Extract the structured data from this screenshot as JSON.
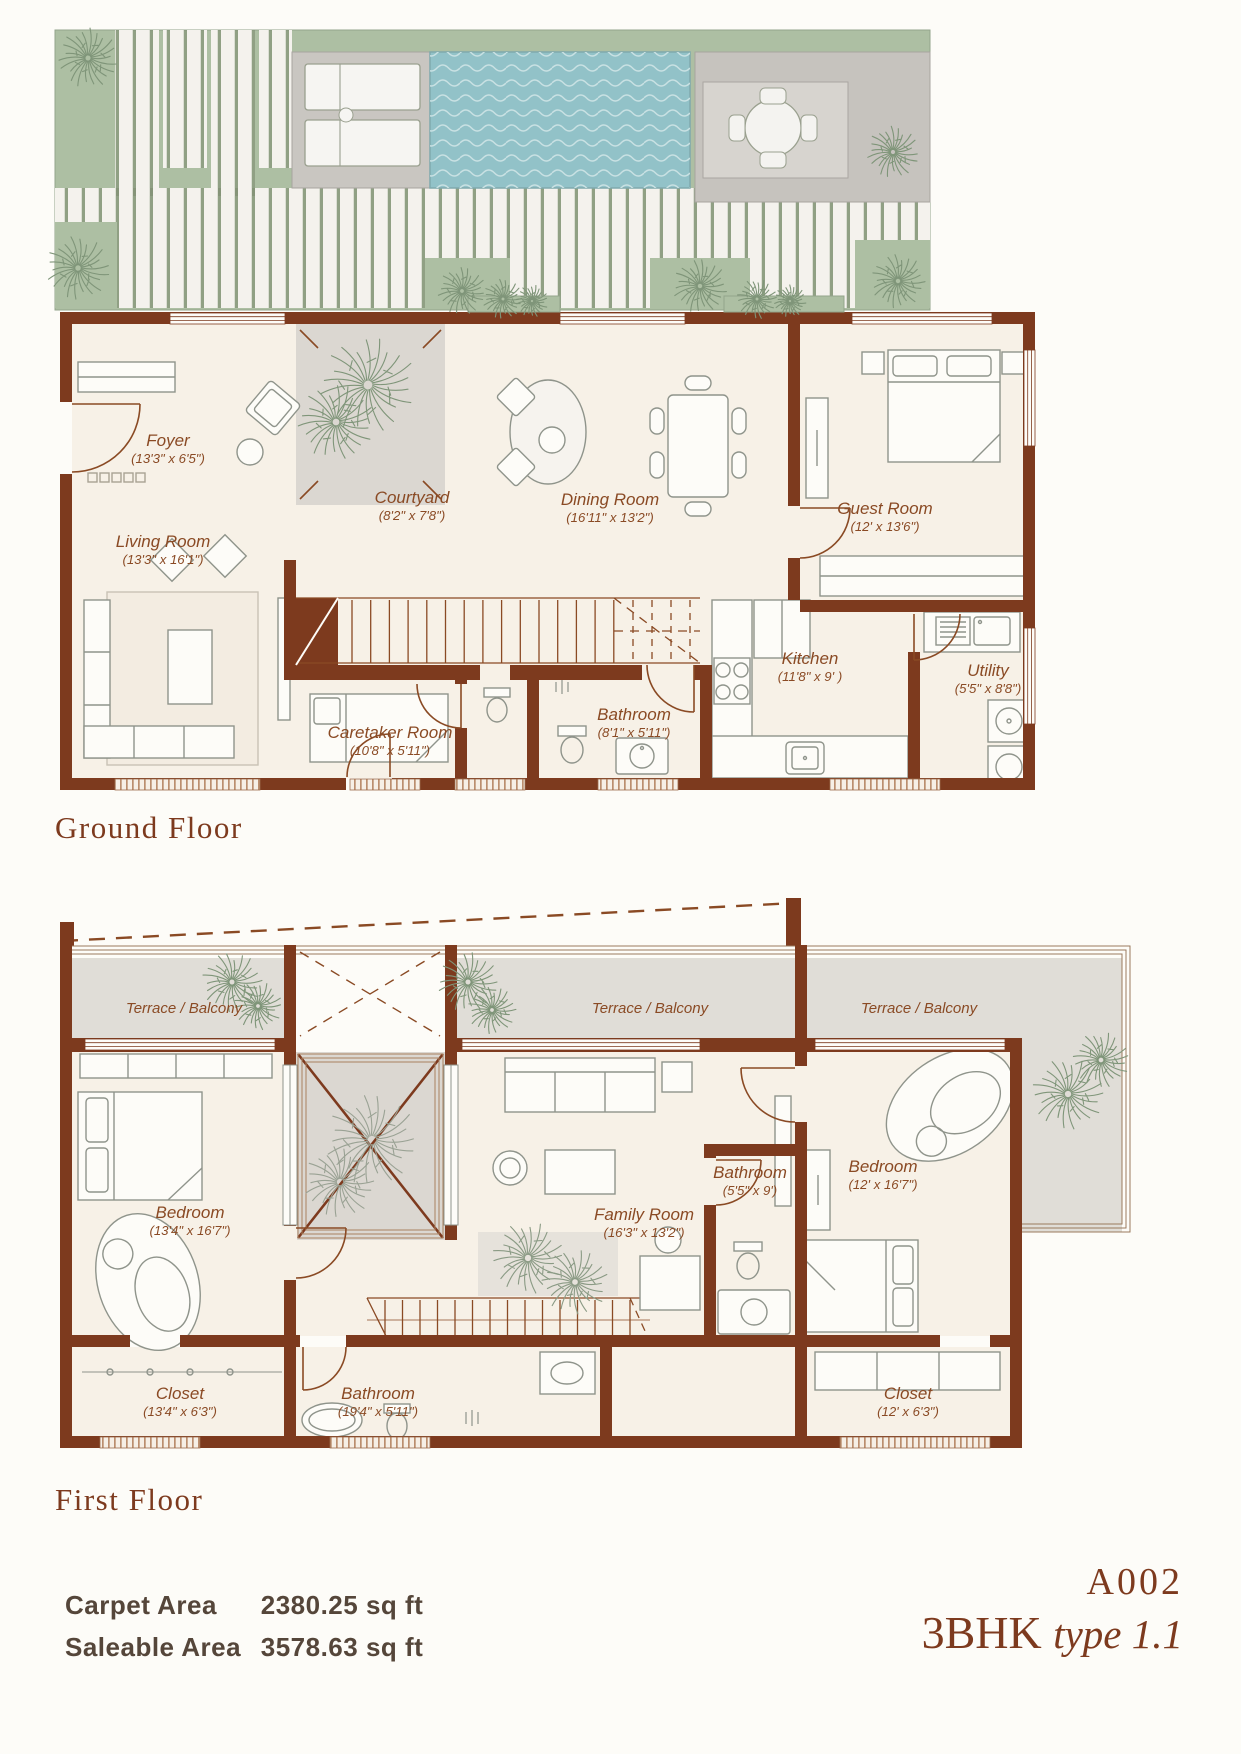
{
  "floors": {
    "ground": {
      "title": "Ground Floor",
      "rooms": [
        {
          "id": "foyer",
          "name": "Foyer",
          "dims": "(13'3\" x 6'5\")"
        },
        {
          "id": "living",
          "name": "Living Room",
          "dims": "(13'3\" x 16'1\")"
        },
        {
          "id": "courtyard",
          "name": "Courtyard",
          "dims": "(8'2\" x 7'8\")"
        },
        {
          "id": "dining",
          "name": "Dining Room",
          "dims": "(16'11\" x 13'2\")"
        },
        {
          "id": "guest",
          "name": "Guest Room",
          "dims": "(12' x 13'6\")"
        },
        {
          "id": "caretaker",
          "name": "Caretaker Room",
          "dims": "(10'8\" x 5'11\")"
        },
        {
          "id": "bathroom",
          "name": "Bathroom",
          "dims": "(8'1\" x 5'11\")"
        },
        {
          "id": "kitchen",
          "name": "Kitchen",
          "dims": "(11'8\" x 9' )"
        },
        {
          "id": "utility",
          "name": "Utility",
          "dims": "(5'5\" x 8'8\")"
        }
      ]
    },
    "first": {
      "title": "First Floor",
      "terraces": [
        "Terrace / Balcony",
        "Terrace / Balcony",
        "Terrace / Balcony"
      ],
      "rooms": [
        {
          "id": "bedroom1",
          "name": "Bedroom",
          "dims": "(13'4\" x 16'7\")"
        },
        {
          "id": "family",
          "name": "Family Room",
          "dims": "(16'3\" x 13'2\")"
        },
        {
          "id": "bedroom2",
          "name": "Bedroom",
          "dims": "(12' x 16'7\")"
        },
        {
          "id": "bathroom_small",
          "name": "Bathroom",
          "dims": "(5'5\" x 9')"
        },
        {
          "id": "closet1",
          "name": "Closet",
          "dims": "(13'4\" x 6'3\")"
        },
        {
          "id": "bathroom_big",
          "name": "Bathroom",
          "dims": "(19'4\" x 5'11\")"
        },
        {
          "id": "closet2",
          "name": "Closet",
          "dims": "(12' x 6'3\")"
        }
      ]
    }
  },
  "footer": {
    "carpet_label": "Carpet Area",
    "carpet_value": "2380.25 sq ft",
    "saleable_label": "Saleable Area",
    "saleable_value": "3578.63 sq ft",
    "unit_code": "A002",
    "unit_bhk": "3BHK",
    "unit_type": "type 1.1"
  },
  "colors": {
    "wall": "#7d3a1e",
    "label": "#8a4a24",
    "floor": "#f7f1e7",
    "courtyard": "#dbd7d1",
    "terrace": "#e0ddd7",
    "garden_green": "#adbfa3",
    "pool": "#92c2c8",
    "tree": "#7f9579"
  }
}
